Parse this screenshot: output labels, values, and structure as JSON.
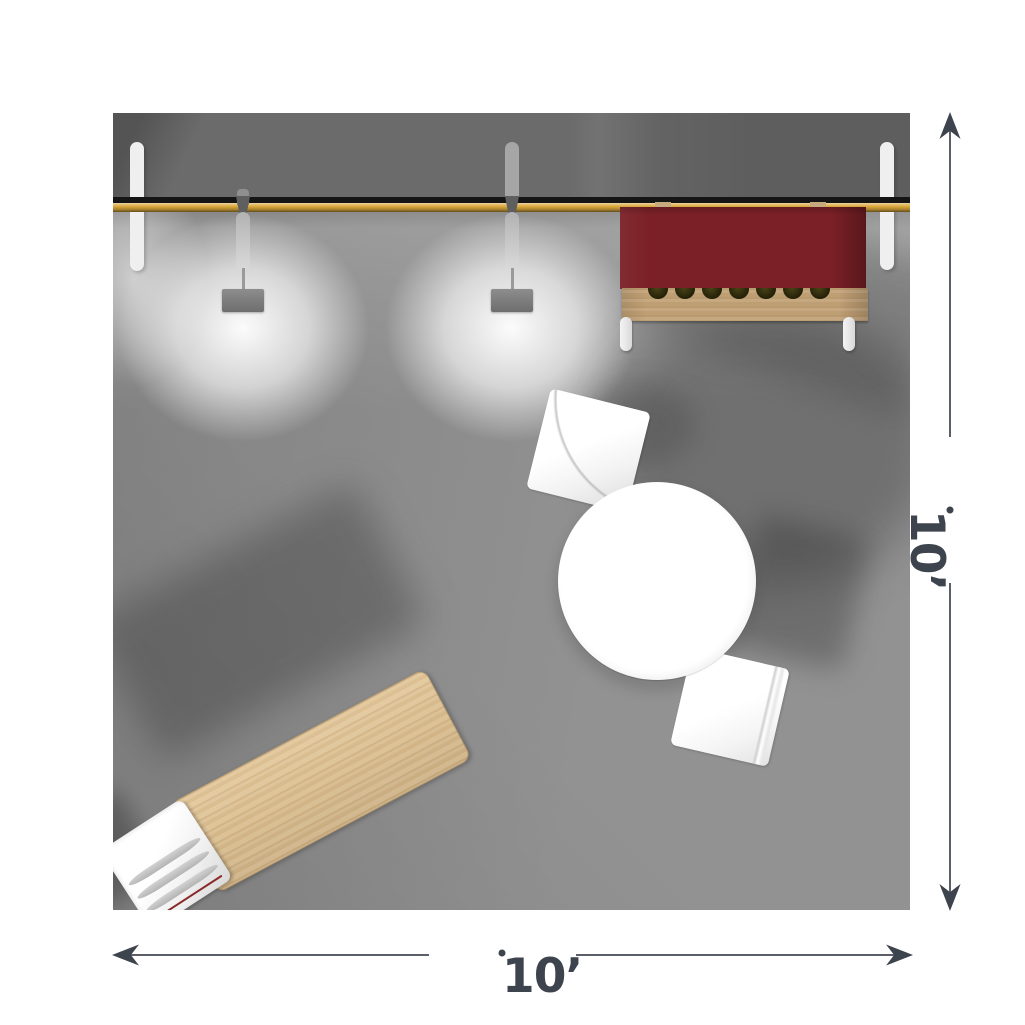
{
  "plan": {
    "title": "10ft x 10ft booth floor plan (top view)",
    "width_label": "10’",
    "height_label": "10’"
  },
  "colors": {
    "floor": "#8c8c8c",
    "wall": "#6b6b6b",
    "rail": "#d9a73b",
    "rail-line": "#151515",
    "counter-red": "#7b2027",
    "wood-table": "#d8bb8d",
    "wood-shelf": "#c2a277",
    "furniture-white": "#ffffff",
    "post-white": "#efefef",
    "dim-text": "#3e444d",
    "dim-line": "#5b6068"
  },
  "objects": {
    "back_wall": "back-wall-with-led-rail",
    "lights": [
      "hanging-light-1",
      "hanging-light-2"
    ],
    "counter": "wall-mounted-counter-with-bottle-shelf",
    "tables": [
      "round-meeting-table",
      "wood-demo-table"
    ],
    "chairs": [
      "guest-chair-1",
      "guest-chair-2",
      "side-chair"
    ]
  }
}
